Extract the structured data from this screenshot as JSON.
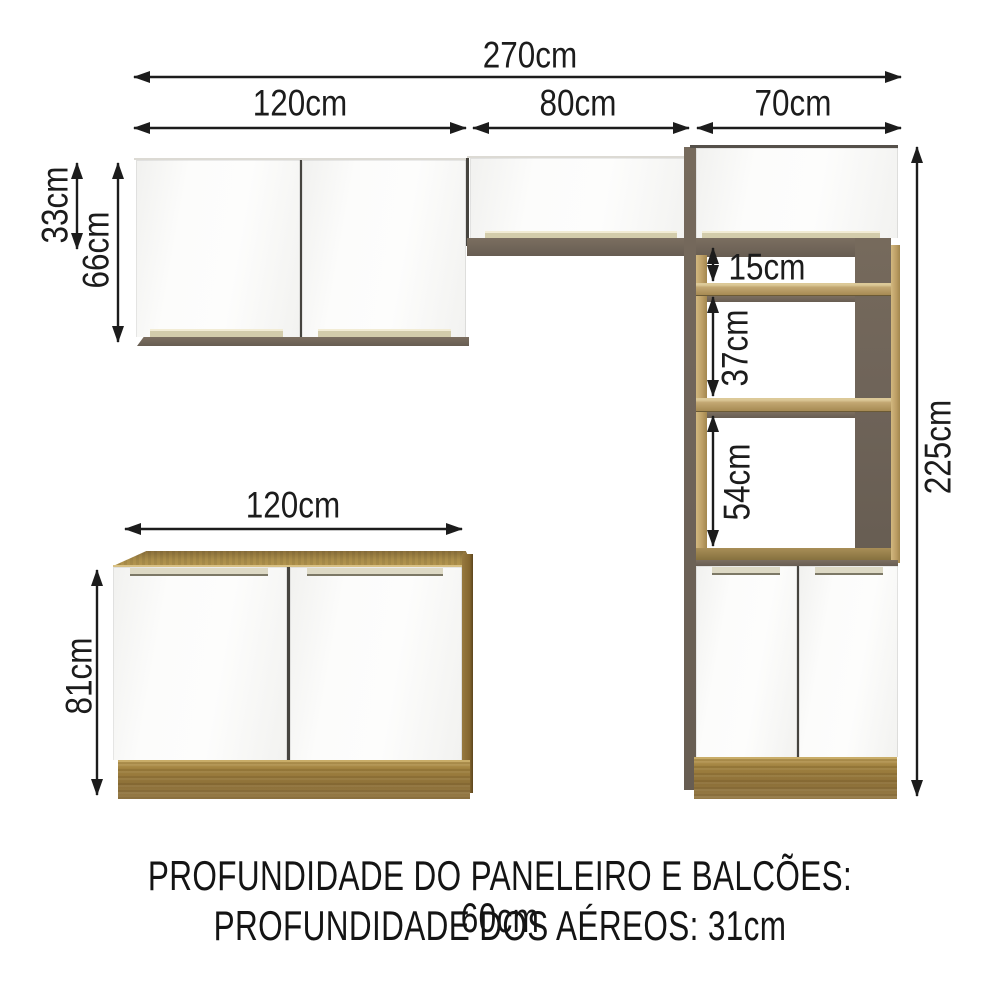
{
  "dimensions": {
    "total_width": "270cm",
    "wall_left_width": "120cm",
    "wall_middle_width": "80cm",
    "tower_width": "70cm",
    "wall_middle_height": "33cm",
    "wall_left_height": "66cm",
    "niche_top_gap": "15cm",
    "niche_middle_gap": "37cm",
    "niche_bottom_gap": "54cm",
    "tower_height": "225cm",
    "base_width": "120cm",
    "base_height": "81cm"
  },
  "footer": {
    "line1": "PROFUNDIDADE DO PANELEIRO E BALCÕES: 60cm",
    "line2": "PROFUNDIDADE DOS AÉREOS: 31cm"
  },
  "colors": {
    "wood": "#9c7f44",
    "wood_light": "#c6ab72",
    "panel_dark": "#6f6459",
    "door_white": "#fbfbfa",
    "handle_strip": "#d3ccab",
    "dimension_line": "#1c1c1c"
  }
}
